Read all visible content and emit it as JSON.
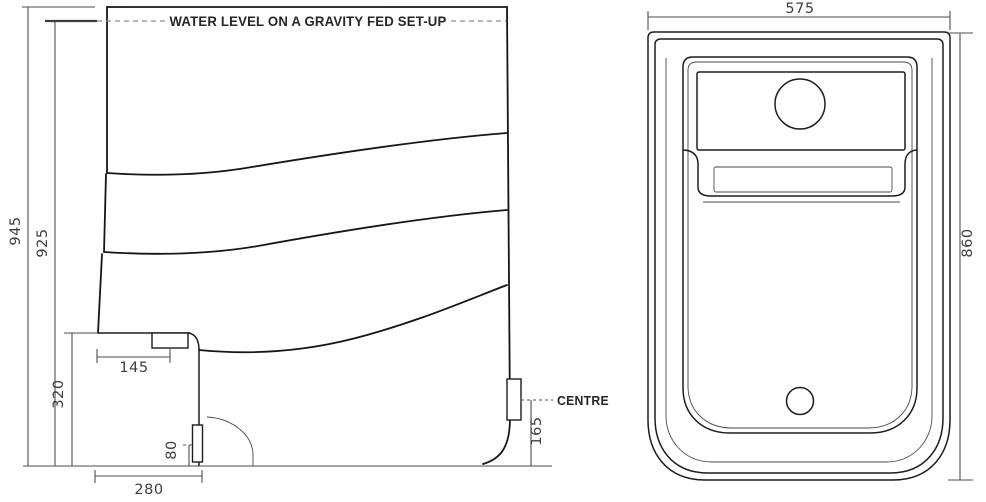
{
  "drawing": {
    "side_view": {
      "water_level_label": "WATER LEVEL ON A GRAVITY FED SET-UP",
      "centre_label": "CENTRE",
      "dimensions": {
        "overall_height": "945",
        "water_level_height": "925",
        "recess_height": "320",
        "fitting_inset": "145",
        "lower_fitting_centre_height": "80",
        "recess_depth": "280",
        "outlet_centre_height": "165"
      }
    },
    "plan_view": {
      "dimensions": {
        "overall_width": "575",
        "overall_depth": "860"
      }
    },
    "colors": {
      "outline": "#1d1d1d",
      "dimension_line": "#4e4e4e",
      "dimension_text": "#3e3e3e",
      "dashed_line": "#8a8a8a",
      "background": "#ffffff"
    }
  }
}
